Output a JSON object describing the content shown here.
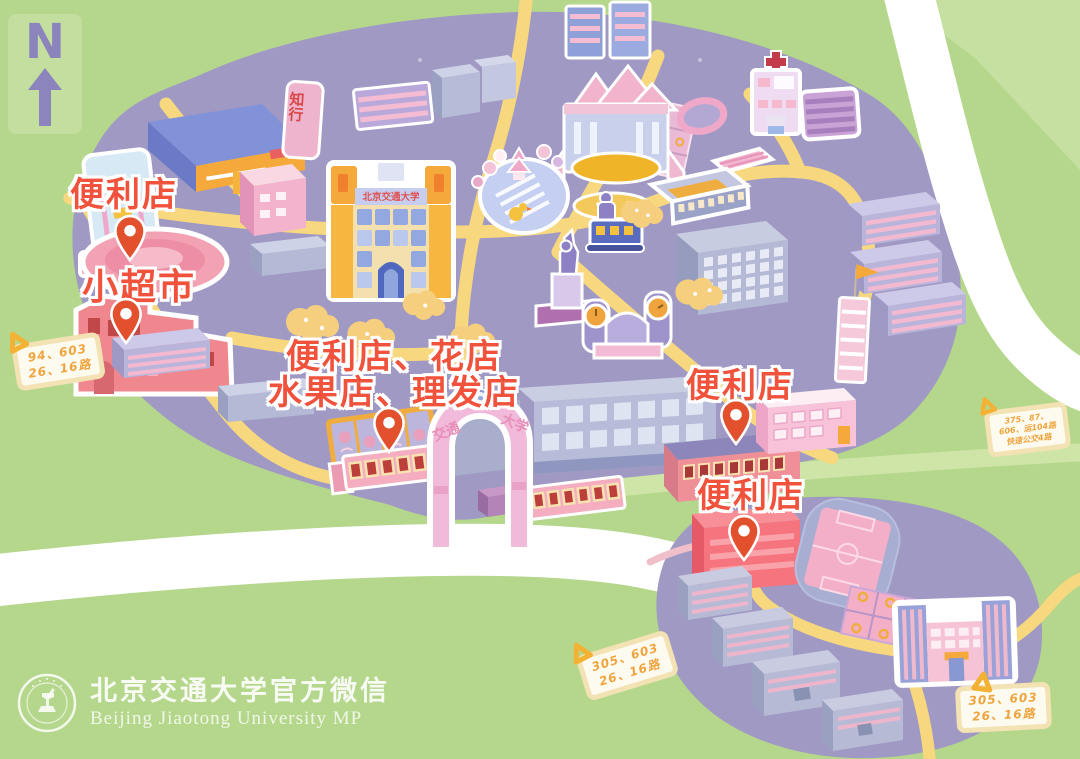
{
  "north": {
    "letter": "N"
  },
  "poi_labels": {
    "nw_convenience": "便利店",
    "supermarket": "小超市",
    "center_line1": "便利店、花店",
    "center_line2": "水果店、理发店",
    "east_convenience": "便利店",
    "south_convenience": "便利店"
  },
  "map_texts": {
    "stone": "知行",
    "main_building_banner": "北京交通大学",
    "gate_left": "交通",
    "gate_right": "大学"
  },
  "bus_tags": {
    "west": {
      "line1": "94、603",
      "line2": "26、16路"
    },
    "east": {
      "line1": "375、87、",
      "line2": "606、运104路",
      "line3": "快速公交4路"
    },
    "south_mid": {
      "line1": "305、603",
      "line2": "26、16路"
    },
    "south_east": {
      "line1": "305、603",
      "line2": "26、16路"
    }
  },
  "footer": {
    "title_cn": "北京交通大学官方微信",
    "title_en": "Beijing Jiaotong University MP"
  },
  "colors": {
    "background": "#b5d78c",
    "campus": "#a099c4",
    "road_yellow": "#f7d87e",
    "road_white": "#ffffff",
    "label_red": "#f0523c",
    "pin": "#e2502d",
    "tag_text": "#f0a43e"
  }
}
